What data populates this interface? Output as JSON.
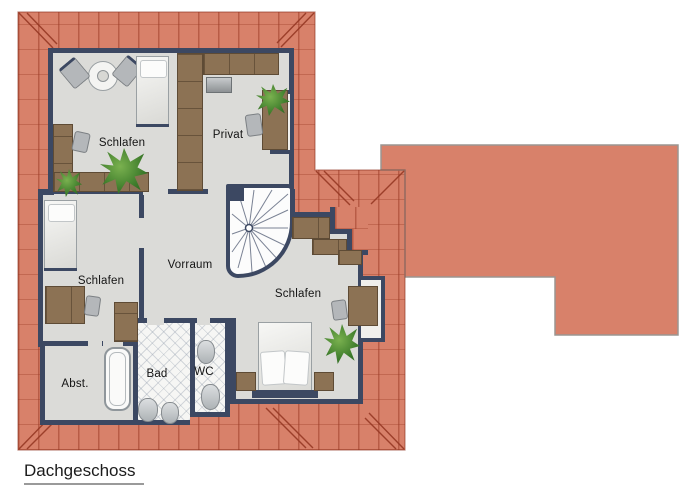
{
  "floor_label": "Dachgeschoss",
  "rooms": {
    "schlafen1": {
      "label": "Schlafen"
    },
    "privat": {
      "label": "Privat"
    },
    "schlafen2": {
      "label": "Schlafen"
    },
    "vorraum": {
      "label": "Vorraum"
    },
    "schlafen3": {
      "label": "Schlafen"
    },
    "abst": {
      "label": "Abst."
    },
    "bad": {
      "label": "Bad"
    },
    "wc": {
      "label": "WC"
    }
  },
  "colors": {
    "roof": "#d8816a",
    "roof_line": "#a84a33",
    "wall": "#3c4862",
    "floor": "#dbdbd8",
    "wood": "#8c7254",
    "wood_dark": "#5e4b35",
    "tile": "#f6f6f4",
    "wing_border": "#9b9591"
  }
}
